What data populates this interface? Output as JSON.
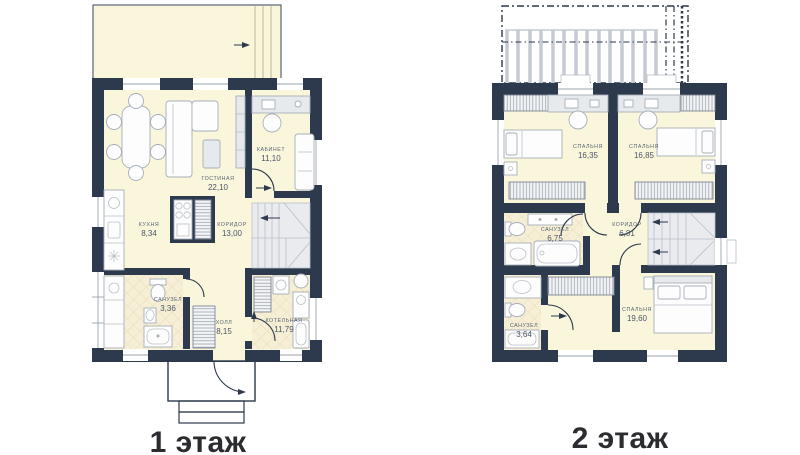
{
  "colors": {
    "wall": "#2d394c",
    "floor": "#faf6dc",
    "tile": "#f6efd6",
    "furniture_stroke": "#a6aeb9",
    "label": "#5a6572",
    "title": "#2a2c2f"
  },
  "floor1": {
    "title": "1 этаж",
    "rooms": [
      {
        "name": "ГОСТИНАЯ",
        "area": "22,10"
      },
      {
        "name": "КАБИНЕТ",
        "area": "11,10"
      },
      {
        "name": "КУХНЯ",
        "area": "8,34"
      },
      {
        "name": "КОРИДОР",
        "area": "13,00"
      },
      {
        "name": "САНУЗЕЛ",
        "area": "3,36"
      },
      {
        "name": "ХОЛЛ",
        "area": "8,15"
      },
      {
        "name": "КОТЕЛЬНАЯ",
        "area": "11,79"
      }
    ]
  },
  "floor2": {
    "title": "2 этаж",
    "rooms": [
      {
        "name": "СПАЛЬНЯ",
        "area": "16,35"
      },
      {
        "name": "СПАЛЬНЯ",
        "area": "16,85"
      },
      {
        "name": "САНУЗЕЛ",
        "area": "6,75"
      },
      {
        "name": "КОРИДОР",
        "area": "6,81"
      },
      {
        "name": "САНУЗЕЛ",
        "area": "3,64"
      },
      {
        "name": "СПАЛЬНЯ",
        "area": "19,60"
      }
    ]
  }
}
